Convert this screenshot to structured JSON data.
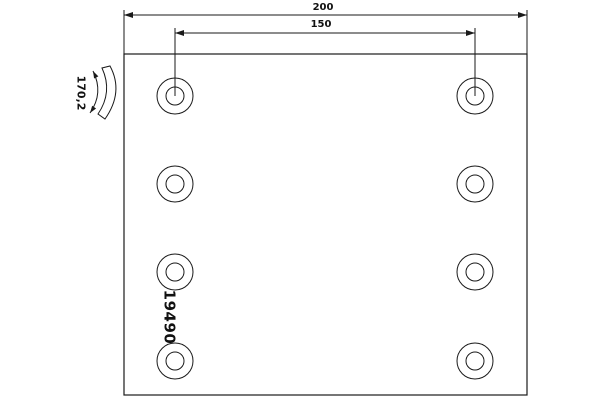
{
  "dimensions": {
    "overall_width": "200",
    "hole_spacing": "150",
    "arc_label": "170,2"
  },
  "part_number": "19490",
  "plate": {
    "hole_rows": 4,
    "hole_columns": 2,
    "hole_count": 8
  },
  "colors": {
    "line": "#1a1a1a",
    "background": "#ffffff"
  }
}
